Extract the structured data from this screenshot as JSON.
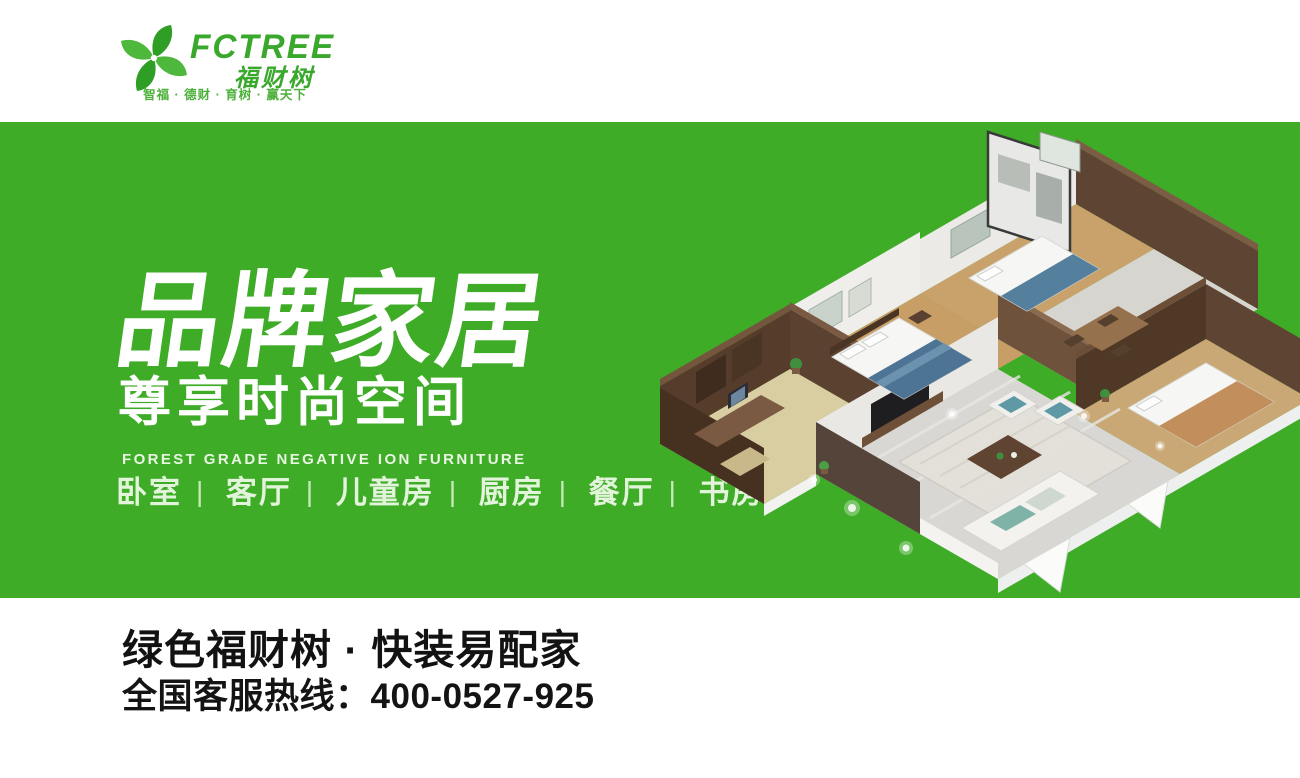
{
  "header": {
    "brand": "FCTREE",
    "brand_cn": "福财树",
    "tagline": "智福 · 德财 · 育树 · 赢天下"
  },
  "hero": {
    "title": "品牌家居",
    "subtitle": "尊享时尚空间",
    "subtitle_en": "FOREST GRADE NEGATIVE ION FURNITURE",
    "rooms": [
      "卧室",
      "客厅",
      "儿童房",
      "厨房",
      "餐厅",
      "书房"
    ],
    "separator": "|"
  },
  "footer": {
    "slogan": "绿色福财树 · 快装易配家",
    "hotline_label": "全国客服热线：",
    "hotline_number": "400-0527-925"
  },
  "colors": {
    "brand_green": "#3fac28",
    "logo_green": "#3aa82c",
    "heading_white": "#ffffff",
    "pale_green_text": "#e2f4da",
    "footer_text": "#121212"
  },
  "illustration": "isometric-apartment-floorplan-render"
}
